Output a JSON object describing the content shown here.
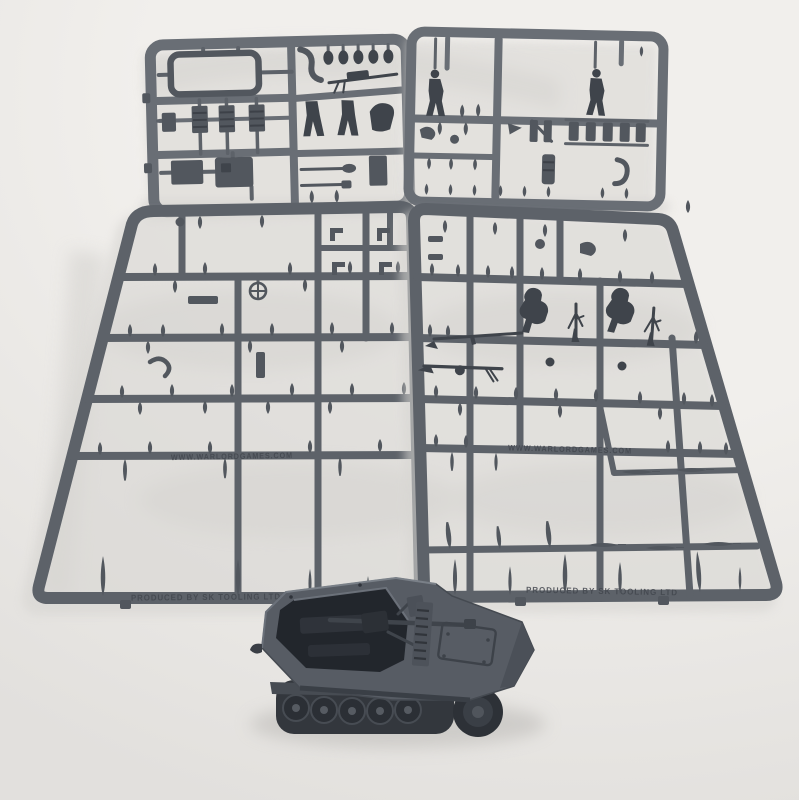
{
  "scene": {
    "background": "#f1efec",
    "background_shadow": "#e2e0dd",
    "shadow_color": "#d7d5d2",
    "sprue_color": "#5d6269",
    "sprue_color_light": "#696e75",
    "part_color": "#52575e",
    "figure_color": "#3f444b",
    "mold_text_color": "#43474e",
    "vehicle_color": "#575c64",
    "vehicle_interior": "#22262c",
    "track_color": "#33373d"
  },
  "molded_text": {
    "website": "WWW.WARLORDGAMES.COM",
    "producer": "PRODUCED BY SK TOOLING LTD"
  }
}
